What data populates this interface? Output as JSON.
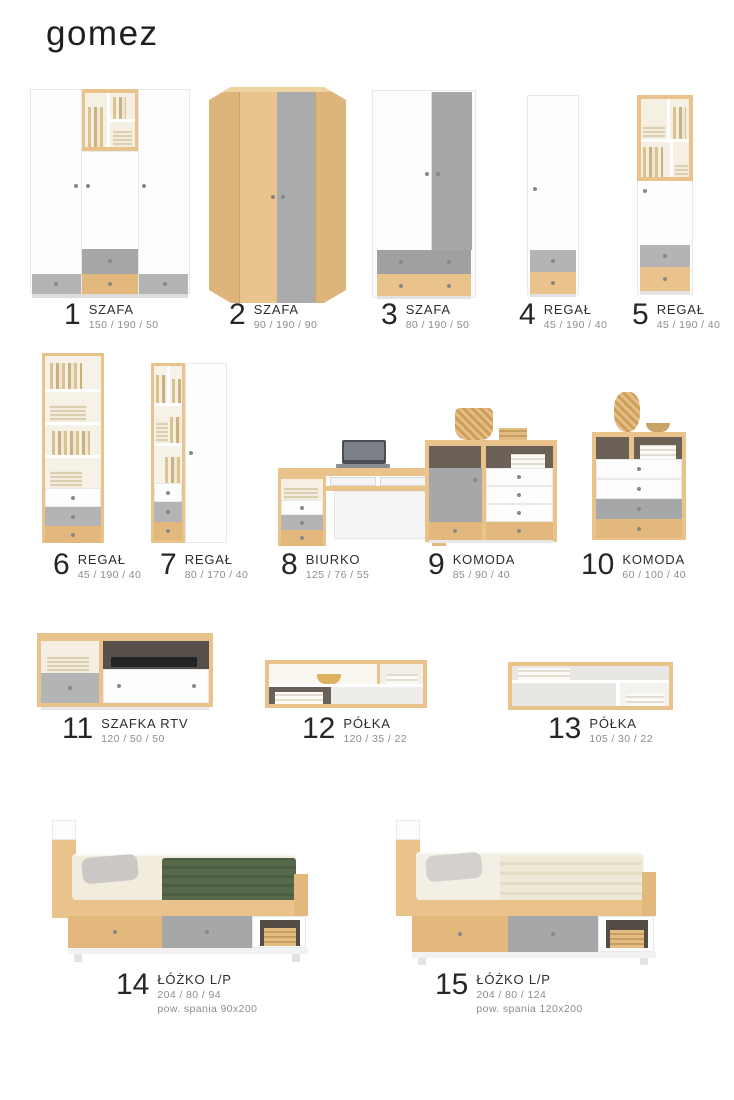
{
  "brand": {
    "logo": "gomez"
  },
  "products": [
    {
      "number": "1",
      "name": "SZAFA",
      "dims": "150 / 190 / 50"
    },
    {
      "number": "2",
      "name": "SZAFA",
      "dims": "90 / 190 / 90"
    },
    {
      "number": "3",
      "name": "SZAFA",
      "dims": "80 / 190 / 50"
    },
    {
      "number": "4",
      "name": "REGAŁ",
      "dims": "45 / 190 / 40"
    },
    {
      "number": "5",
      "name": "REGAŁ",
      "dims": "45 / 190 / 40"
    },
    {
      "number": "6",
      "name": "REGAŁ",
      "dims": "45 / 190 / 40"
    },
    {
      "number": "7",
      "name": "REGAŁ",
      "dims": "80 / 170 / 40"
    },
    {
      "number": "8",
      "name": "BIURKO",
      "dims": "125 / 76 / 55"
    },
    {
      "number": "9",
      "name": "KOMODA",
      "dims": "85 / 90 / 40"
    },
    {
      "number": "10",
      "name": "KOMODA",
      "dims": "60 / 100 / 40"
    },
    {
      "number": "11",
      "name": "SZAFKA RTV",
      "dims": "120 / 50 / 50"
    },
    {
      "number": "12",
      "name": "PÓŁKA",
      "dims": "120 / 35 / 22"
    },
    {
      "number": "13",
      "name": "PÓŁKA",
      "dims": "105 / 30 / 22"
    },
    {
      "number": "14",
      "name": "ŁÓŻKO L/P",
      "dims": "204 / 80 / 94",
      "extra": "pow. spania 90x200"
    },
    {
      "number": "15",
      "name": "ŁÓŻKO L/P",
      "dims": "204 / 80 / 124",
      "extra": "pow. spania 120x200"
    }
  ],
  "colors": {
    "wood": "#e9c38b",
    "wood_dark": "#e2b87c",
    "gray_door": "#a6a7a9",
    "gray_light": "#b3b4b6",
    "interior_dark": "#6b6157",
    "blanket_green": "#57684b",
    "text_dark": "#262626",
    "text_muted": "#8d8d8d",
    "page_bg": "#ffffff"
  }
}
